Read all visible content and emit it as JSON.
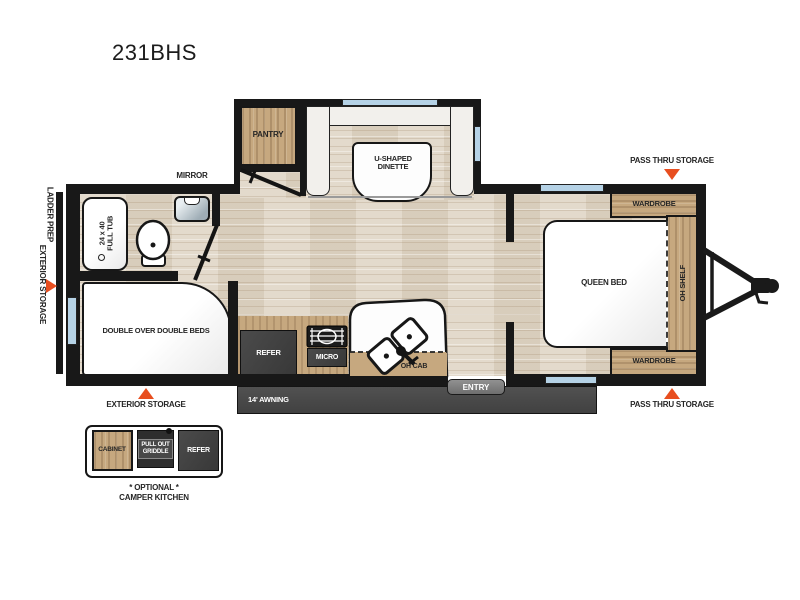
{
  "title": "231BHS",
  "colors": {
    "accent_arrow": "#e84e1f",
    "window_blue": "#b5d2e6",
    "cabinet_wood": "#c6a87f",
    "wall_black": "#181818",
    "appliance_gray": "#414141",
    "floor_tan": "#e0d6c6"
  },
  "floorplan": {
    "labels": {
      "mirror": "MIRROR",
      "pantry": "PANTRY",
      "dinette_line1": "U-SHAPED",
      "dinette_line2": "DINETTE",
      "tub_line1": "24 x 40",
      "tub_line2": "FULL TUB",
      "ladder_prep": "LADDER PREP",
      "exterior_storage_side": "EXTERIOR STORAGE",
      "exterior_storage_bottom": "EXTERIOR STORAGE",
      "bunks": "DOUBLE OVER DOUBLE BEDS",
      "refer": "REFER",
      "micro": "MICRO",
      "oh_cab": "OH CAB",
      "entry": "ENTRY",
      "awning": "14' AWNING",
      "pass_thru_top": "PASS THRU STORAGE",
      "pass_thru_bottom": "PASS THRU STORAGE",
      "wardrobe_top": "WARDROBE",
      "wardrobe_bottom": "WARDROBE",
      "queen_bed": "QUEEN BED",
      "oh_shelf": "OH SHELF"
    },
    "inset": {
      "cabinet": "CABINET",
      "griddle_line1": "PULL OUT",
      "griddle_line2": "GRIDDLE",
      "refer": "REFER",
      "caption_line1": "* OPTIONAL *",
      "caption_line2": "CAMPER KITCHEN"
    }
  }
}
